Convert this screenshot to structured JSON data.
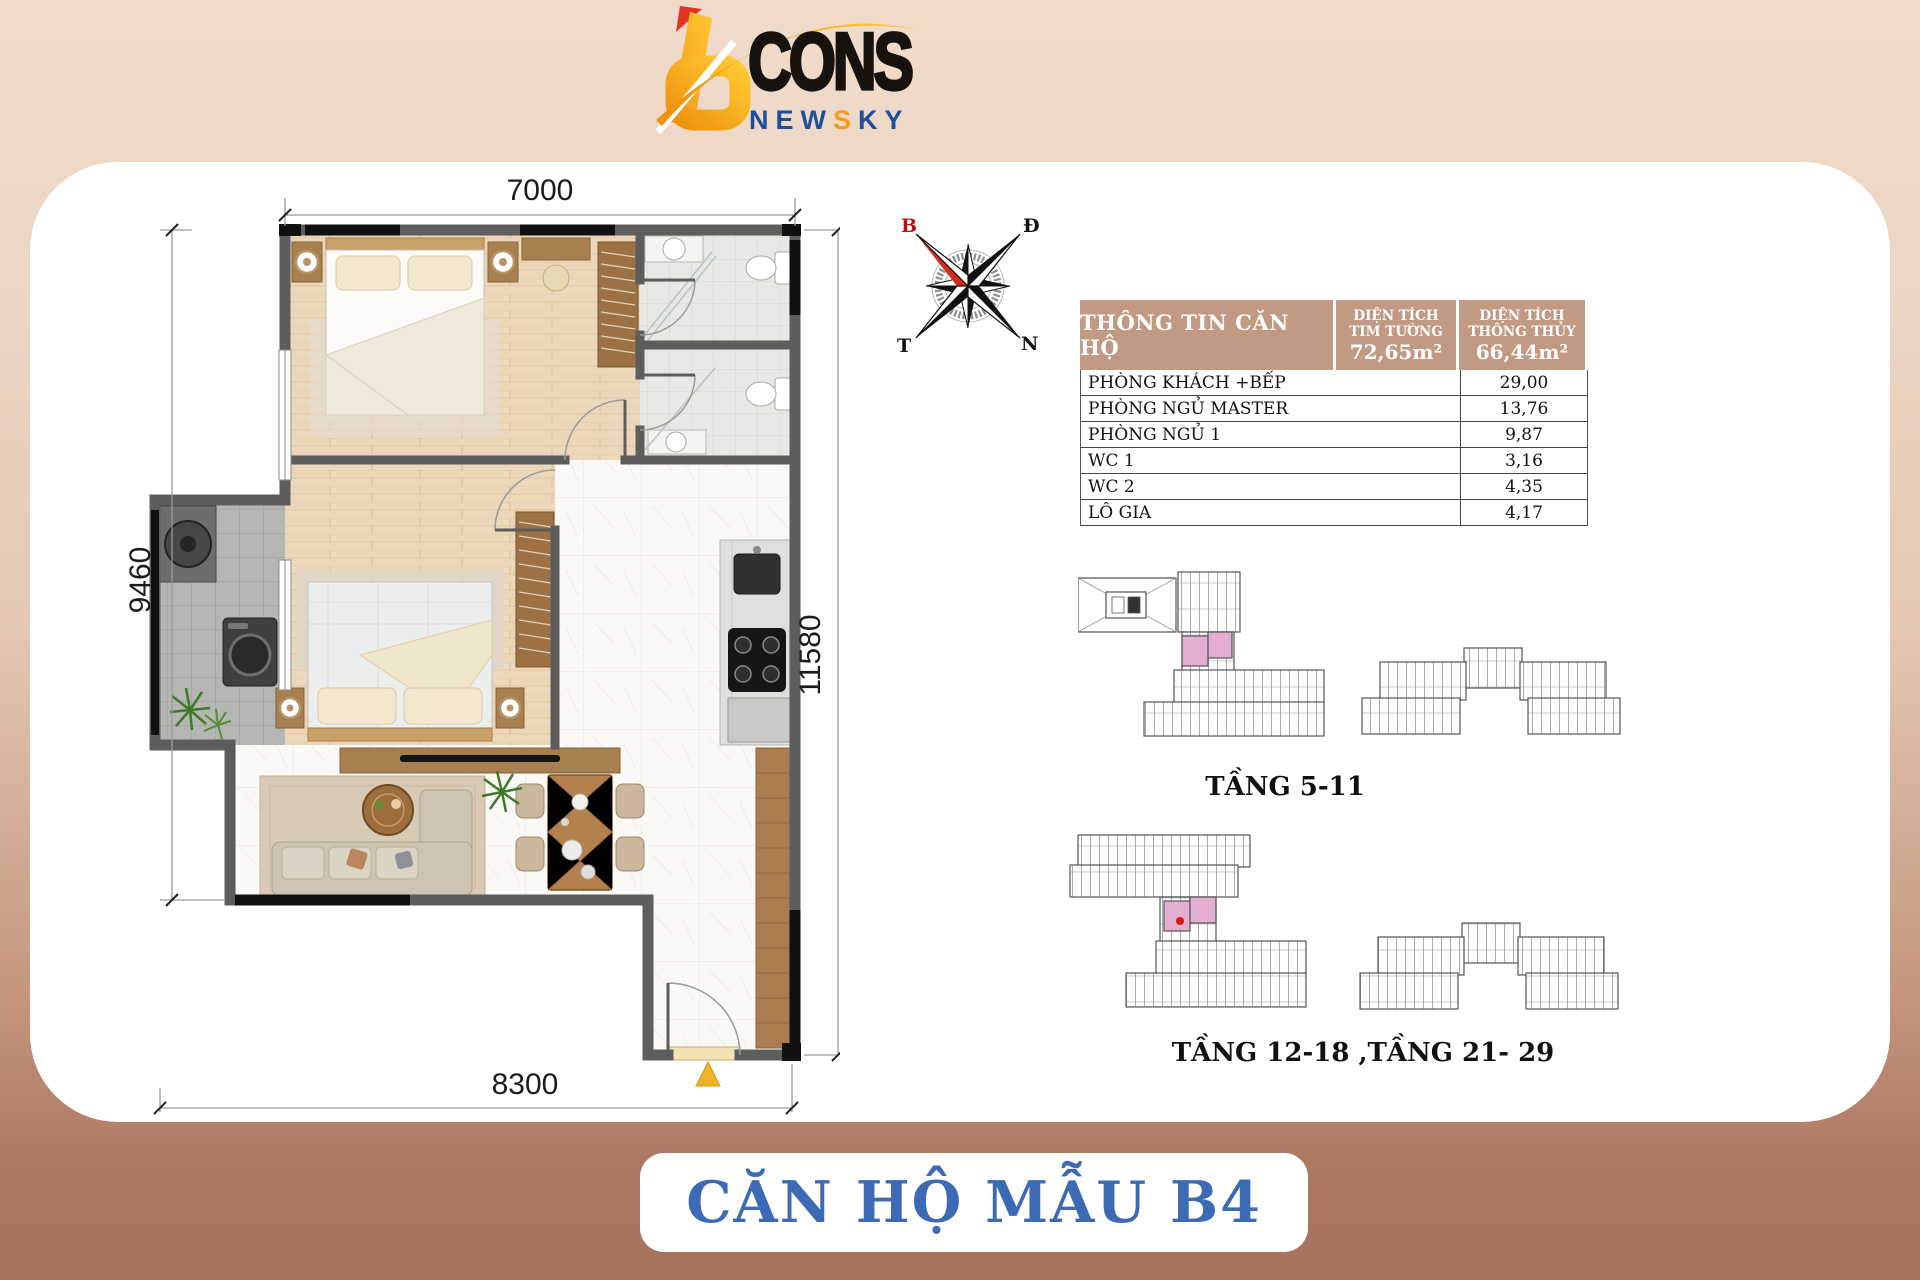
{
  "logo": {
    "cons": "CONS",
    "newsky_pre": "NEW",
    "newsky_s": "S",
    "newsky_post": "KY"
  },
  "compass": {
    "b": "B",
    "d": "Đ",
    "t": "T",
    "n": "N"
  },
  "floor_plan": {
    "dim_top": "7000",
    "dim_left": "9460",
    "dim_right": "11580",
    "dim_bottom": "8300"
  },
  "info_table": {
    "title": "THÔNG TIN CĂN HỘ",
    "col_tim_tuong": {
      "line1": "DIỆN TÍCH",
      "line2": "TIM TƯỜNG",
      "value": "72,65m²"
    },
    "col_thong_thuy": {
      "line1": "DIỆN TÍCH",
      "line2": "THÔNG THỦY",
      "value": "66,44m²"
    },
    "rows": [
      {
        "label": "PHÒNG KHÁCH +BẾP",
        "value": "29,00"
      },
      {
        "label": "PHÒNG NGỦ MASTER",
        "value": "13,76"
      },
      {
        "label": "PHÒNG NGỦ 1",
        "value": "9,87"
      },
      {
        "label": "WC 1",
        "value": "3,16"
      },
      {
        "label": "WC 2",
        "value": "4,35"
      },
      {
        "label": "LÔ GIA",
        "value": "4,17"
      }
    ]
  },
  "site_plans": {
    "plan1_label": "TẦNG 5-11",
    "plan2_label": "TẦNG 12-18 ,TẦNG 21- 29"
  },
  "footer": {
    "unit_name": "CĂN HỘ MẪU B4"
  },
  "colors": {
    "accent_blue": "#3c6ab5",
    "brand_orange": "#f6a21a",
    "table_header_bg": "#c29a83",
    "highlight_pink": "#e4aed2",
    "entry_marker_yellow": "#f0b12b",
    "band_brown": "#a8745e",
    "band_peach": "#f0dbca"
  }
}
